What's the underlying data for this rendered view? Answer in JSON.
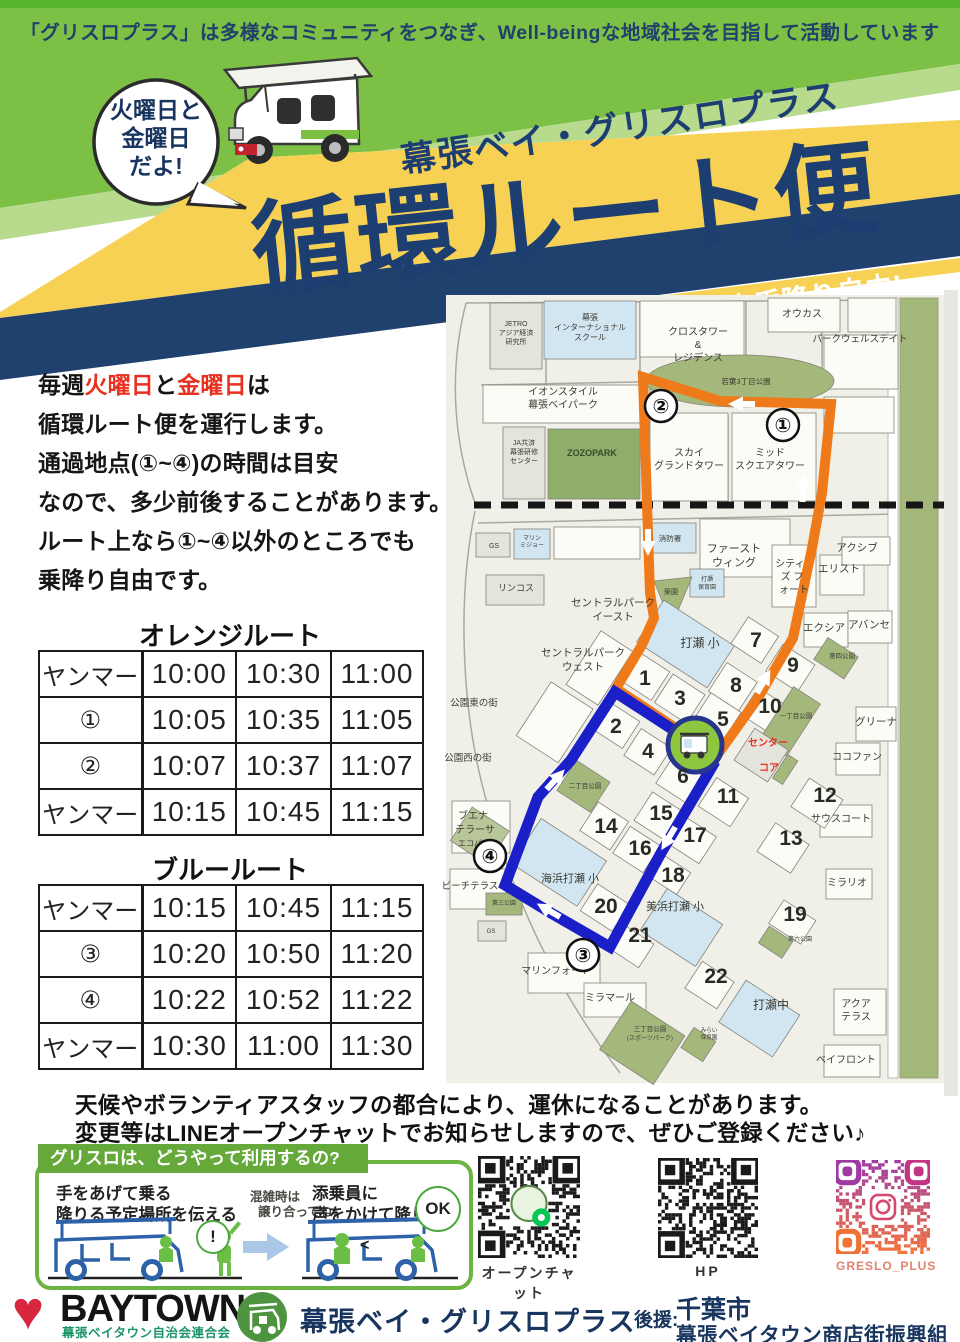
{
  "colors": {
    "header_green": "#7cc145",
    "light_green": "#b7da8d",
    "yellow": "#f7d154",
    "navy": "#20406e",
    "red_accent": "#e8301f",
    "orange_route": "#ef7a1a",
    "blue_route": "#1a1fc8",
    "park_green": "#a5b87c",
    "school_blue": "#d2e6f2",
    "usage_green": "#6cb33f"
  },
  "banner": {
    "text": "「グリスロプラス」は多様なコミュニティをつなぎ、Well-beingな地域社会を目指して活動しています"
  },
  "bubble": {
    "lines": [
      "火曜日と",
      "金曜日",
      "だよ!"
    ]
  },
  "title": {
    "brand": "幕張ベイ・グリスロプラス",
    "main": "循環ルート便"
  },
  "ribbon": {
    "items": [
      "ベイ太くんに乗っておでかけしよう!",
      "料金無料!",
      "途中乗降り自由!"
    ]
  },
  "intro": {
    "lines": [
      [
        {
          "t": "毎週"
        },
        {
          "t": "火曜日",
          "red": true
        },
        {
          "t": "と"
        },
        {
          "t": "金曜日",
          "red": true
        },
        {
          "t": "は"
        }
      ],
      [
        {
          "t": "循環ルート便を運行します。"
        }
      ],
      [
        {
          "t": "通過地点(①~④)の時間は目安"
        }
      ],
      [
        {
          "t": "なので、多少前後することがあります。"
        }
      ],
      [
        {
          "t": "ルート上なら①~④以外のところでも"
        }
      ],
      [
        {
          "t": "乗降り自由です。"
        }
      ]
    ]
  },
  "tables": {
    "orange": {
      "title": "オレンジルート",
      "rows": [
        [
          "ヤンマー",
          "10:00",
          "10:30",
          "11:00"
        ],
        [
          "①",
          "10:05",
          "10:35",
          "11:05"
        ],
        [
          "②",
          "10:07",
          "10:37",
          "11:07"
        ],
        [
          "ヤンマー",
          "10:15",
          "10:45",
          "11:15"
        ]
      ]
    },
    "blue": {
      "title": "ブルールート",
      "rows": [
        [
          "ヤンマー",
          "10:15",
          "10:45",
          "11:15"
        ],
        [
          "③",
          "10:20",
          "10:50",
          "11:20"
        ],
        [
          "④",
          "10:22",
          "10:52",
          "11:22"
        ],
        [
          "ヤンマー",
          "10:30",
          "11:00",
          "11:30"
        ]
      ]
    }
  },
  "map": {
    "labels": [
      {
        "t": "JETRO",
        "x": 88,
        "y": 33,
        "s": 7
      },
      {
        "t": "アジア経済",
        "x": 88,
        "y": 42,
        "s": 7
      },
      {
        "t": "研究所",
        "x": 88,
        "y": 51,
        "s": 7
      },
      {
        "t": "幕張",
        "x": 162,
        "y": 27,
        "s": 8
      },
      {
        "t": "インターナショナル",
        "x": 162,
        "y": 37,
        "s": 8
      },
      {
        "t": "スクール",
        "x": 162,
        "y": 47,
        "s": 8
      },
      {
        "t": "オウカス",
        "x": 374,
        "y": 24,
        "s": 10
      },
      {
        "t": "クロスタワー",
        "x": 270,
        "y": 42,
        "s": 10
      },
      {
        "t": "&",
        "x": 270,
        "y": 55,
        "s": 10
      },
      {
        "t": "レジデンス",
        "x": 270,
        "y": 68,
        "s": 10
      },
      {
        "t": "パークウェルステイト",
        "x": 432,
        "y": 49,
        "s": 9.5
      },
      {
        "t": "若葉3丁目公園",
        "x": 318,
        "y": 91,
        "s": 7.5
      },
      {
        "t": "イオンスタイル",
        "x": 135,
        "y": 102,
        "s": 10
      },
      {
        "t": "幕張ベイパーク",
        "x": 135,
        "y": 115,
        "s": 10
      },
      {
        "t": "ZOZOPARK",
        "x": 164,
        "y": 163,
        "s": 9,
        "c": "#3a4a30",
        "w": "bold"
      },
      {
        "t": "JA共済",
        "x": 96,
        "y": 152,
        "s": 7
      },
      {
        "t": "幕張研修",
        "x": 96,
        "y": 161,
        "s": 7
      },
      {
        "t": "センター",
        "x": 96,
        "y": 170,
        "s": 7
      },
      {
        "t": "スカイ",
        "x": 261,
        "y": 163,
        "s": 10
      },
      {
        "t": "グランドタワー",
        "x": 261,
        "y": 176,
        "s": 10
      },
      {
        "t": "ミッド",
        "x": 342,
        "y": 163,
        "s": 10
      },
      {
        "t": "スクエアタワー",
        "x": 342,
        "y": 176,
        "s": 10
      },
      {
        "t": "GS",
        "x": 66,
        "y": 255,
        "s": 7
      },
      {
        "t": "マリン",
        "x": 104,
        "y": 247,
        "s": 6
      },
      {
        "t": "ミジョー",
        "x": 104,
        "y": 254,
        "s": 6
      },
      {
        "t": "消防署",
        "x": 242,
        "y": 248,
        "s": 7.5
      },
      {
        "t": "ファースト",
        "x": 306,
        "y": 259,
        "s": 11
      },
      {
        "t": "ウィング",
        "x": 306,
        "y": 273,
        "s": 11
      },
      {
        "t": "シティ",
        "x": 362,
        "y": 274,
        "s": 10
      },
      {
        "t": "ズ フ",
        "x": 364,
        "y": 287,
        "s": 10
      },
      {
        "t": "ォート",
        "x": 366,
        "y": 300,
        "s": 10
      },
      {
        "t": "エリスト",
        "x": 411,
        "y": 279,
        "s": 10.5
      },
      {
        "t": "アクシブ",
        "x": 429,
        "y": 258,
        "s": 10.5
      },
      {
        "t": "リンコス",
        "x": 88,
        "y": 298,
        "s": 9
      },
      {
        "t": "セントラルパーク",
        "x": 185,
        "y": 313,
        "s": 10.5
      },
      {
        "t": "イースト",
        "x": 185,
        "y": 327,
        "s": 10.5
      },
      {
        "t": "築園",
        "x": 243,
        "y": 301,
        "s": 7
      },
      {
        "t": "打瀬",
        "x": 279,
        "y": 288,
        "s": 6
      },
      {
        "t": "保育園",
        "x": 279,
        "y": 296,
        "s": 6
      },
      {
        "t": "セントラルパーク",
        "x": 155,
        "y": 363,
        "s": 10.5
      },
      {
        "t": "ウェスト",
        "x": 155,
        "y": 377,
        "s": 10.5
      },
      {
        "t": "エクシア",
        "x": 396,
        "y": 338,
        "s": 10.5
      },
      {
        "t": "アバンセ",
        "x": 441,
        "y": 335,
        "s": 10.5
      },
      {
        "t": "第四公園",
        "x": 414,
        "y": 365,
        "s": 6.5
      },
      {
        "t": "打瀬 小",
        "x": 272,
        "y": 354,
        "s": 12
      },
      {
        "t": "公園東の街",
        "x": 46,
        "y": 413,
        "s": 9.5
      },
      {
        "t": "一丁目公園",
        "x": 368,
        "y": 425,
        "s": 6.5
      },
      {
        "t": "グリーナ",
        "x": 448,
        "y": 432,
        "s": 10.5
      },
      {
        "t": "センター",
        "x": 340,
        "y": 453,
        "s": 10,
        "c": "#e8301f",
        "w": "bold"
      },
      {
        "t": "ココファン",
        "x": 429,
        "y": 467,
        "s": 10
      },
      {
        "t": "コア",
        "x": 341,
        "y": 478,
        "s": 10,
        "c": "#e8301f",
        "w": "bold"
      },
      {
        "t": "公園西の街",
        "x": 40,
        "y": 468,
        "s": 9.5
      },
      {
        "t": "二丁目公園",
        "x": 157,
        "y": 495,
        "s": 6.5
      },
      {
        "t": "サウスコート",
        "x": 413,
        "y": 529,
        "s": 10
      },
      {
        "t": "ブエナ",
        "x": 45,
        "y": 526,
        "s": 10
      },
      {
        "t": "テラーサ",
        "x": 47,
        "y": 540,
        "s": 10
      },
      {
        "t": "エコパーク",
        "x": 50,
        "y": 553,
        "s": 8
      },
      {
        "t": "海浜打瀬 小",
        "x": 142,
        "y": 589,
        "s": 11
      },
      {
        "t": "美浜打瀬 小",
        "x": 247,
        "y": 617,
        "s": 11
      },
      {
        "t": "ビーチテラス",
        "x": 42,
        "y": 596,
        "s": 9.5
      },
      {
        "t": "第三公園",
        "x": 76,
        "y": 612,
        "s": 6
      },
      {
        "t": "ミラリオ",
        "x": 419,
        "y": 593,
        "s": 10
      },
      {
        "t": "GS",
        "x": 63,
        "y": 640,
        "s": 6
      },
      {
        "t": "第六公園",
        "x": 372,
        "y": 648,
        "s": 6
      },
      {
        "t": "マリンフォート",
        "x": 128,
        "y": 681,
        "s": 10
      },
      {
        "t": "ミラマール",
        "x": 182,
        "y": 708,
        "s": 10
      },
      {
        "t": "三丁目公園",
        "x": 222,
        "y": 738,
        "s": 6.5
      },
      {
        "t": "(スポーツパーク)",
        "x": 222,
        "y": 747,
        "s": 6
      },
      {
        "t": "みらい",
        "x": 281,
        "y": 739,
        "s": 5.5
      },
      {
        "t": "保育園",
        "x": 281,
        "y": 746,
        "s": 5.5
      },
      {
        "t": "打瀬中",
        "x": 343,
        "y": 716,
        "s": 12
      },
      {
        "t": "アクア",
        "x": 428,
        "y": 714,
        "s": 10
      },
      {
        "t": "テラス",
        "x": 428,
        "y": 727,
        "s": 10
      },
      {
        "t": "ベイフロント",
        "x": 418,
        "y": 770,
        "s": 10
      }
    ],
    "numbers": [
      {
        "n": "1",
        "x": 217,
        "y": 392
      },
      {
        "n": "2",
        "x": 188,
        "y": 440
      },
      {
        "n": "3",
        "x": 252,
        "y": 412
      },
      {
        "n": "4",
        "x": 220,
        "y": 465
      },
      {
        "n": "5",
        "x": 295,
        "y": 433
      },
      {
        "n": "6",
        "x": 255,
        "y": 490
      },
      {
        "n": "7",
        "x": 328,
        "y": 354
      },
      {
        "n": "8",
        "x": 308,
        "y": 399
      },
      {
        "n": "9",
        "x": 365,
        "y": 379
      },
      {
        "n": "10",
        "x": 342,
        "y": 420
      },
      {
        "n": "11",
        "x": 300,
        "y": 510
      },
      {
        "n": "12",
        "x": 397,
        "y": 509
      },
      {
        "n": "13",
        "x": 363,
        "y": 552
      },
      {
        "n": "14",
        "x": 178,
        "y": 540
      },
      {
        "n": "15",
        "x": 233,
        "y": 527
      },
      {
        "n": "16",
        "x": 212,
        "y": 562
      },
      {
        "n": "17",
        "x": 267,
        "y": 549
      },
      {
        "n": "18",
        "x": 245,
        "y": 589
      },
      {
        "n": "19",
        "x": 367,
        "y": 628
      },
      {
        "n": "20",
        "x": 178,
        "y": 620
      },
      {
        "n": "21",
        "x": 212,
        "y": 649
      },
      {
        "n": "22",
        "x": 288,
        "y": 690
      }
    ],
    "stops": [
      {
        "n": "①",
        "x": 355,
        "y": 132
      },
      {
        "n": "②",
        "x": 233,
        "y": 113
      },
      {
        "n": "③",
        "x": 155,
        "y": 662
      },
      {
        "n": "④",
        "x": 62,
        "y": 563
      }
    ]
  },
  "notice": {
    "lines": [
      "天候やボランティアスタッフの都合により、運休になることがあります。",
      "変更等はLINEオープンチャットでお知らせしますので、ぜひご登録ください♪"
    ]
  },
  "usage": {
    "header": "グリスロは、どうやって利用するの?",
    "step1": [
      "手をあげて乗る",
      "降りる予定場所を伝える"
    ],
    "hint": [
      "混雑時は",
      "譲り合ってね♪"
    ],
    "step2": [
      "添乗員に",
      "声をかけて降りる"
    ],
    "bubble1": "!",
    "bubble2": "OK"
  },
  "qr": {
    "items": [
      {
        "label": "オープンチャット",
        "style": "line"
      },
      {
        "label": "HP",
        "style": "plain"
      },
      {
        "label": "GRESLO_PLUS",
        "style": "insta"
      }
    ]
  },
  "footer": {
    "baytown": "BAYTOWN",
    "baytown_sub": "幕張ベイタウン自治会連合会",
    "brand": "幕張ベイ・グリスロプラス",
    "support_label": "後援:",
    "support1": "千葉市",
    "support2": "幕張ベイタウン商店街振興組合"
  }
}
